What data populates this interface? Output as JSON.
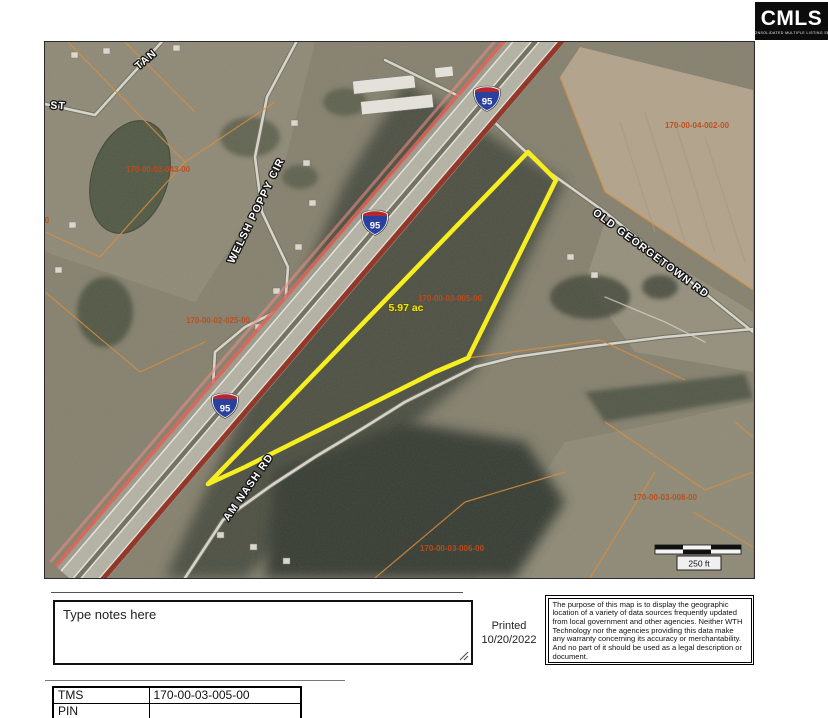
{
  "logo": {
    "brand": "CMLS",
    "tagline": "CONSOLIDATED MULTIPLE LISTING SERVICE"
  },
  "map": {
    "shield_route": "95",
    "road_labels": {
      "tan": "TAN",
      "st": "ST",
      "welsh_poppy": "WELSH POPPY CIR",
      "old_georgetown": "OLD GEORGETOWN RD",
      "am_nash": "AM NASH RD"
    },
    "parcel_labels": {
      "p043": "170-00-02-043-00",
      "p004": "170-00-04-002-00",
      "p005": "170-00-03-005-00",
      "p025": "170-00-02-025-00",
      "p008": "170-00-03-008-00",
      "p006": "170-00-03-006-00",
      "edge_fragment": "22-00"
    },
    "subject_parcel": {
      "acreage": "5.97 ac",
      "tms": "170-00-03-005-00",
      "outline_color": "#f7ee1f"
    },
    "scale_label": "250 ft",
    "colors": {
      "parcel_line": "#dc8a35",
      "parcel_text": "#bf4c1a",
      "highlight_yellow": "#f7ee1f",
      "highway_dark_red": "#8e2214",
      "highway_pink": "#e06055",
      "shield_blue": "#2b3f9e",
      "shield_red": "#b3282d"
    }
  },
  "notes": {
    "placeholder": "Type notes here"
  },
  "print_info": {
    "label": "Printed",
    "date": "10/20/2022"
  },
  "disclaimer": "The purpose of this map is to display the geographic location of a variety of data sources frequently updated from local government and other agencies. Neither WTH Technology nor the agencies providing this data make any warranty concerning its accuracy or merchantability. And no part of it should be used as a legal description or document.",
  "parcel_table": {
    "rows": [
      {
        "label": "TMS",
        "value": "170-00-03-005-00"
      },
      {
        "label": "PIN",
        "value": ""
      }
    ]
  }
}
